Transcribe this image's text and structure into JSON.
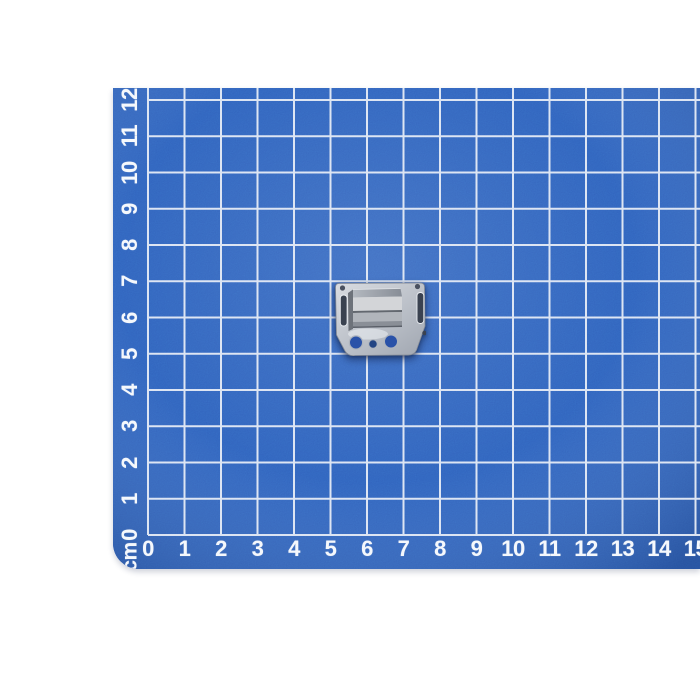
{
  "photo": {
    "background_color": "#ffffff"
  },
  "mat": {
    "surface_color": "#2e5db8",
    "edge_shade_color": "#27509e",
    "grid_line_color": "#e6ecf6",
    "label_color": "#f5f8fc",
    "unit_label": "cm",
    "bottom_ruler": {
      "labels": [
        "0",
        "1",
        "2",
        "3",
        "4",
        "5",
        "6",
        "7",
        "8",
        "9",
        "10",
        "11",
        "12",
        "13",
        "14",
        "15"
      ]
    },
    "left_ruler": {
      "labels": [
        "0",
        "1",
        "2",
        "3",
        "4",
        "5",
        "6",
        "7",
        "8",
        "9",
        "10",
        "11",
        "12"
      ]
    }
  },
  "object": {
    "plate_light": "#d9dce1",
    "plate_mid": "#bcc1c9",
    "plate_edge": "#868c96",
    "plate_shade": "#a3a9b3",
    "block_side": "#6d727a",
    "block_top_light": "#b3b8bf",
    "block_top_dark": "#878d96",
    "block_front_light": "#d3d5d8",
    "block_front_mid": "#b1b5bb",
    "block_front_low": "#8a8f97",
    "block_seam": "#63686f",
    "block_edge": "#5b6069",
    "slot_dark": "#3a4250",
    "corner_hole": "#4a5160",
    "hole_blue": "#2a52a8",
    "hole_blue_dark": "#234583",
    "hole_rim": "#aeb4bd",
    "highlight": "#edf0f4"
  }
}
